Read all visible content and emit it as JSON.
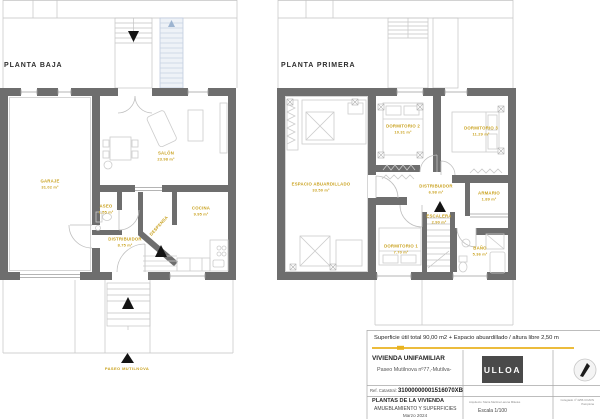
{
  "plans": {
    "planta_baja": {
      "title": "PLANTA BAJA",
      "street_label": "PASEO MUTILNOVA",
      "rooms": [
        {
          "name": "GARAJE",
          "area": "31.02 m²"
        },
        {
          "name": "SALÓN",
          "area": "23.98 m²"
        },
        {
          "name": "ASEO",
          "area": "1.55 m²"
        },
        {
          "name": "DESPENSA",
          "area": ""
        },
        {
          "name": "COCINA",
          "area": "9.95 m²"
        },
        {
          "name": "DISTRIBUIDOR",
          "area": "8.75 m²"
        }
      ]
    },
    "planta_primera": {
      "title": "PLANTA PRIMERA",
      "rooms": [
        {
          "name": "ESPACIO ABUARDILLADO",
          "area": "33.50 m²"
        },
        {
          "name": "DORMITORIO 2",
          "area": "10.31 m²"
        },
        {
          "name": "DORMITORIO 3",
          "area": "11.29 m²"
        },
        {
          "name": "DISTRIBUIDOR",
          "area": "6.98 m²"
        },
        {
          "name": "ESCALERA",
          "area": "2.90 m²"
        },
        {
          "name": "ARMARIO",
          "area": "1.89 m²"
        },
        {
          "name": "DORMITORIO 1",
          "area": "7.70 m²"
        },
        {
          "name": "BAÑO",
          "area": "5.36 m²"
        }
      ]
    }
  },
  "title_block": {
    "surface_note": "Superficie útil total 90,00 m2 + Espacio abuardillado / altura libre 2,50 m",
    "project": "VIVIENDA UNIFAMILIAR",
    "address": "Paseo Mutilnova nº77,-Mutilva-",
    "cadastral_label": "Ref. Catastral:",
    "cadastral_ref": "31000000001516070XB",
    "sheet_title": "PLANTAS DE LA VIVIENDA",
    "sheet_subtitle": "AMUEBLAMIENTO Y SUPERFICIES",
    "date": "Marzo 2024",
    "logo_text": "ULLOA",
    "architect_line": "Arquitecto: María Martínez-arena Mikeles",
    "collegiate_line": "Colegiado nº 4256 COAVN Pamplona",
    "scale_label": "Escala 1/100"
  },
  "colors": {
    "wall": "#6e6e6e",
    "label_yellow": "#c9a11d",
    "accent_rule": "#e9b320",
    "logo_bg": "#4a4a4a"
  }
}
